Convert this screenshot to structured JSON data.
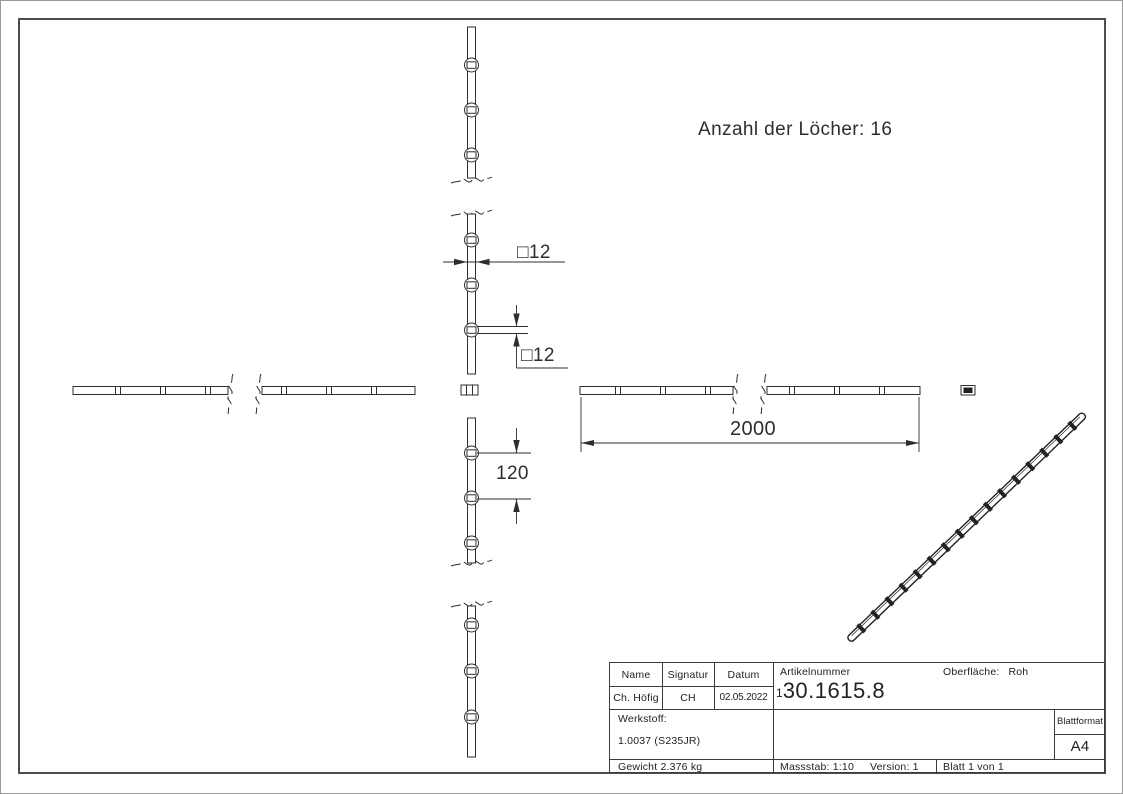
{
  "annotations": {
    "hole_count_note": "Anzahl der Löcher: 16",
    "dim_profile": "□12",
    "dim_hole": "□12",
    "dim_spacing": "120",
    "dim_length": "2000"
  },
  "title_block": {
    "name_label": "Name",
    "signature_label": "Signatur",
    "date_label": "Datum",
    "name_value": "Ch. Höfig",
    "signature_value": "CH",
    "date_value": "02.05.2022",
    "article_label": "Artikelnummer",
    "article_prefix": "1",
    "article_number": "30.1615.8",
    "surface_label": "Oberfläche:",
    "surface_value": "Roh",
    "material_label": "Werkstoff:",
    "material_value": "1.0037 (S235JR)",
    "sheet_format_label": "Blattformat",
    "sheet_format_value": "A4",
    "weight_value": "Gewicht 2.376 kg",
    "scale_value": "Massstab: 1:10",
    "version_value": "Version: 1",
    "page_value": "Blatt 1 von 1"
  },
  "colors": {
    "line": "#2e2e2e",
    "frame": "#4d4d4d",
    "paper": "#ffffff"
  }
}
